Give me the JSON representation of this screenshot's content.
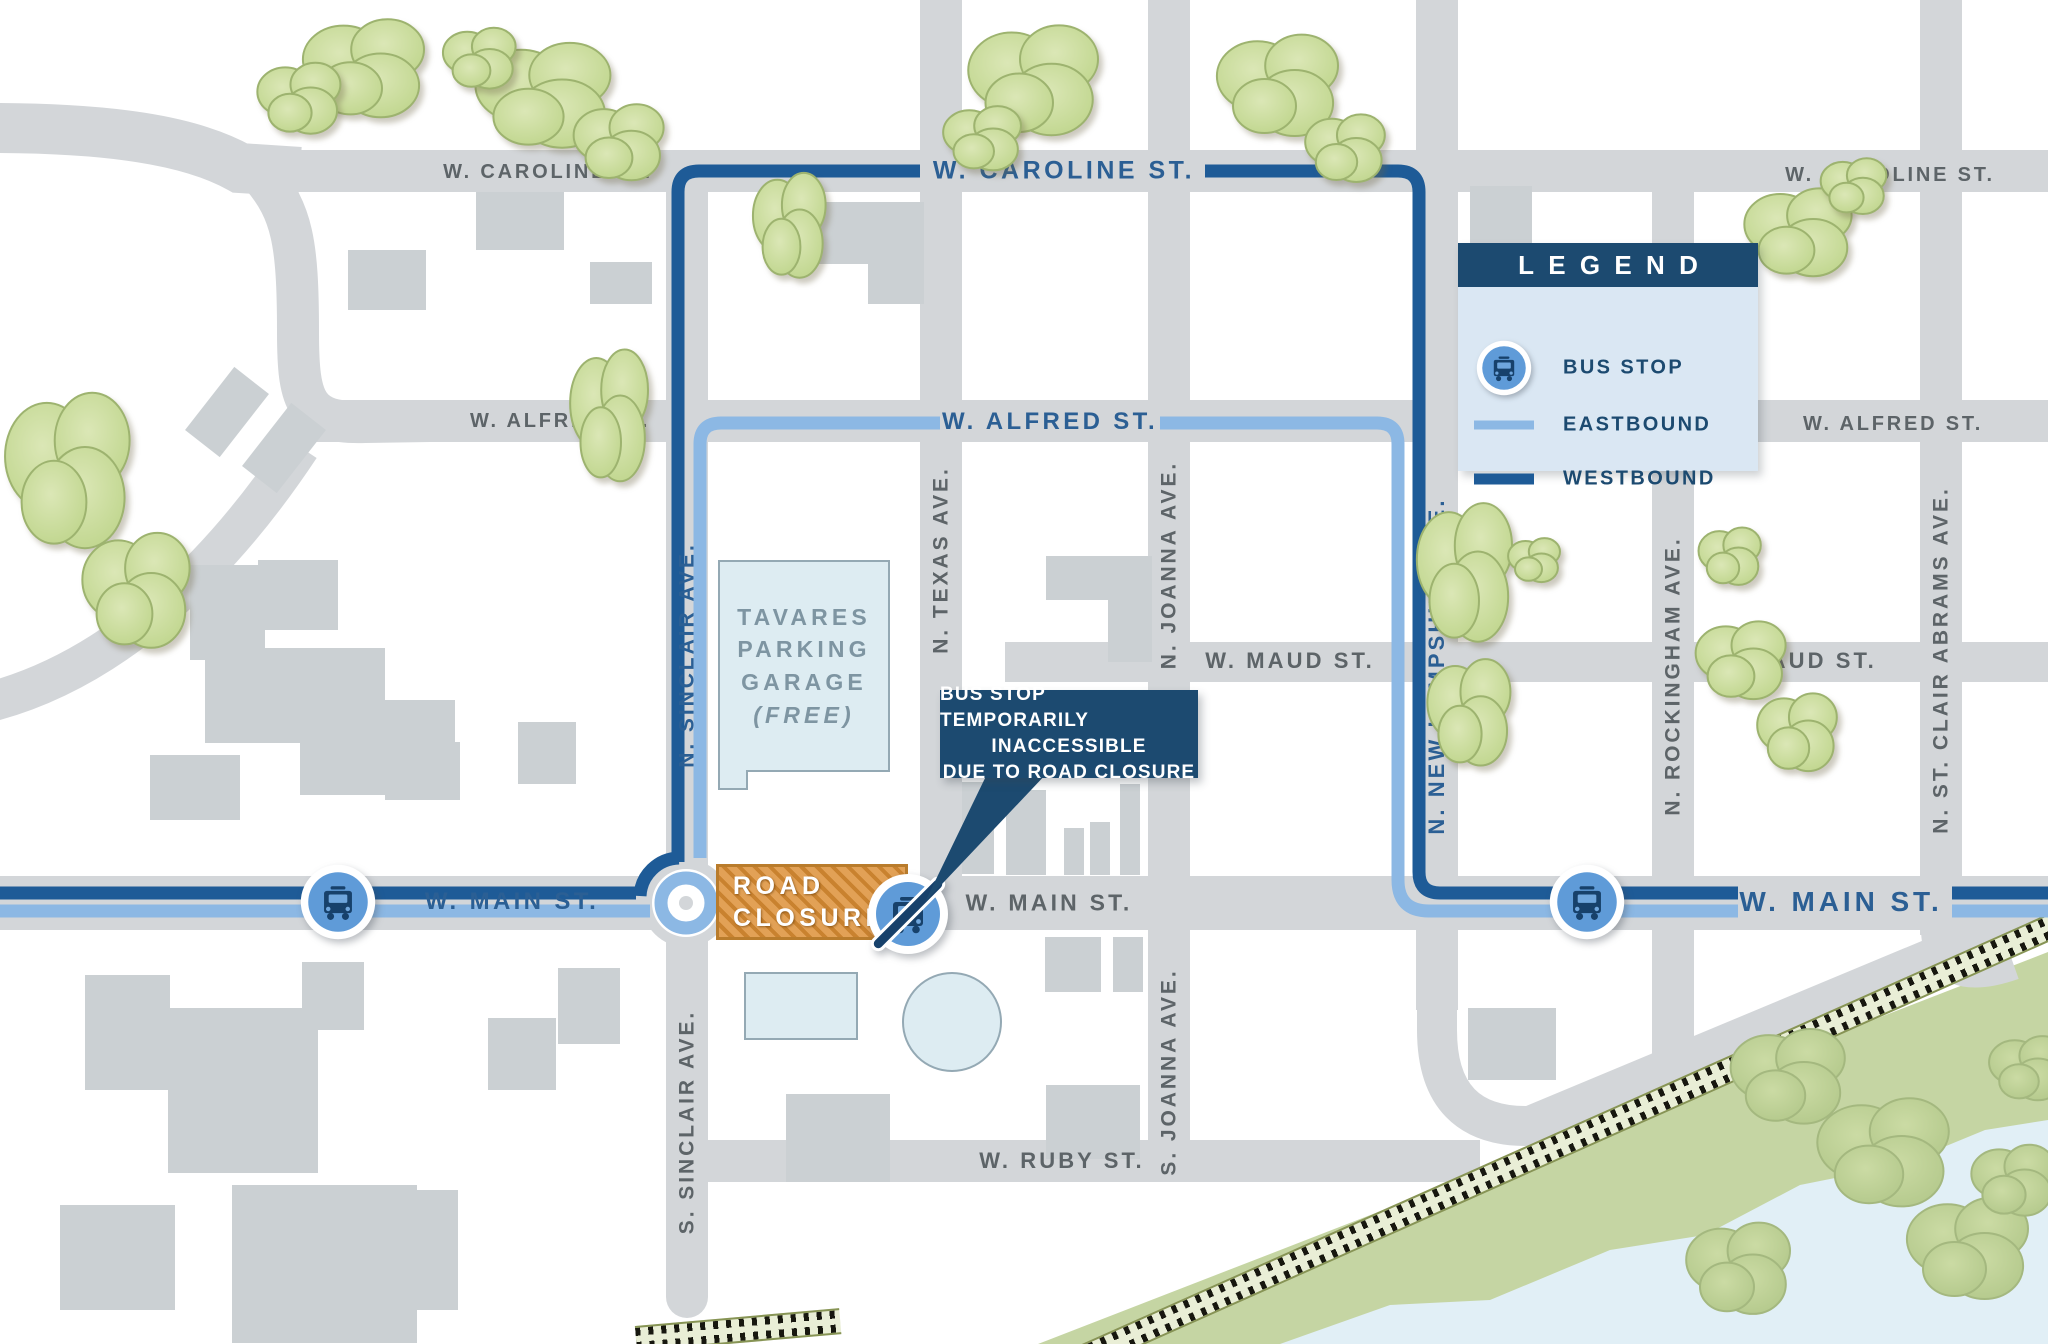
{
  "streets": {
    "caroline": "W. CAROLINE ST.",
    "alfred": "W. ALFRED ST.",
    "maud": "W. MAUD ST.",
    "main": "W. MAIN ST.",
    "ruby": "W. RUBY ST.",
    "n_sinclair": "N. SINCLAIR AVE.",
    "s_sinclair": "S. SINCLAIR AVE.",
    "n_texas": "N. TEXAS AVE.",
    "n_joanna": "N. JOANNA AVE.",
    "s_joanna": "S. JOANNA AVE.",
    "n_new_hampshire": "N. NEW HAMPSHIRE AVE.",
    "n_rockingham": "N. ROCKINGHAM AVE.",
    "n_st_clair": "N. ST. CLAIR ABRAMS AVE."
  },
  "legend": {
    "title": "LEGEND",
    "items": [
      {
        "icon": "bus-stop-icon",
        "label": "BUS STOP"
      },
      {
        "icon": "eastbound-line",
        "label": "EASTBOUND"
      },
      {
        "icon": "westbound-line",
        "label": "WESTBOUND"
      }
    ]
  },
  "callout": {
    "lines": [
      "BUS STOP TEMPORARILY",
      "INACCESSIBLE",
      "DUE TO ROAD CLOSURE"
    ]
  },
  "closure": {
    "lines": [
      "ROAD",
      "CLOSURE"
    ]
  },
  "garage": {
    "lines": [
      "TAVARES",
      "PARKING",
      "GARAGE",
      "(FREE)"
    ]
  },
  "colors": {
    "westbound": "#1e5b97",
    "eastbound": "#8cb8e4",
    "navy_box": "#1c4a70",
    "road_gray": "#d3d6d9",
    "closure_orange": "#e2a156",
    "bus_circle": "#5f9bd8",
    "park_green": "#c5d5a3",
    "tree_green": "#c3d797",
    "water_blue": "#e1eff6",
    "label_gray": "#5d6468",
    "label_blue": "#2b5f94"
  }
}
